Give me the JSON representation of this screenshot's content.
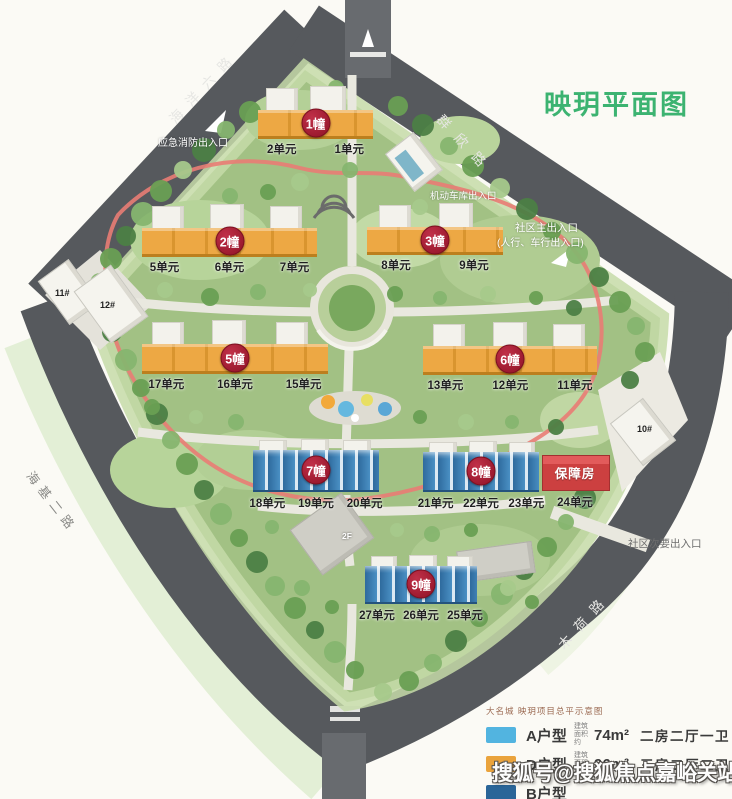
{
  "title": "映玥平面图",
  "roads": {
    "top_left": "海洋六路",
    "top_right": "群欣路",
    "bottom_left": "海基二路",
    "bottom_right": "木荷路"
  },
  "entrances": {
    "fire": "应急消防出入口",
    "garage": "机动车库出入口",
    "main_line1": "社区主出入口",
    "main_line2": "(人行、车行出入口)",
    "secondary": "社区次要出入口"
  },
  "buildings": [
    {
      "badge": "1幢",
      "units": [
        "2单元",
        "1单元"
      ]
    },
    {
      "badge": "2幢",
      "units": [
        "5单元",
        "6单元",
        "7单元"
      ]
    },
    {
      "badge": "3幢",
      "units": [
        "8单元",
        "9单元"
      ]
    },
    {
      "badge": "5幢",
      "units": [
        "17单元",
        "16单元",
        "15单元"
      ]
    },
    {
      "badge": "6幢",
      "units": [
        "13单元",
        "12单元",
        "11单元"
      ]
    },
    {
      "badge": "7幢",
      "units": [
        "18单元",
        "19单元",
        "20单元"
      ]
    },
    {
      "badge": "8幢",
      "units": [
        "21单元",
        "22单元",
        "23单元"
      ]
    },
    {
      "badge": "保障房",
      "units": [
        "24单元"
      ]
    },
    {
      "badge": "9幢",
      "units": [
        "27单元",
        "26单元",
        "25单元"
      ]
    }
  ],
  "site_labels": {
    "b11": "11#",
    "b12": "12#",
    "b10": "10#",
    "f2": "2F"
  },
  "legend": {
    "caption": "大名城 映玥项目总平示意图",
    "rows": [
      {
        "swatch": "#52b4e0",
        "label": "A户型",
        "area_prefix": "建筑面积约",
        "area": "74m²",
        "desc": "二房二厅一卫"
      },
      {
        "swatch": "#eaa33c",
        "label": "D户型",
        "area_prefix": "建筑面积约",
        "area": "96m²",
        "desc": "三房二厅二卫"
      },
      {
        "swatch": "#2a6598",
        "label": "B户型",
        "area_prefix": "",
        "area": "",
        "desc": ""
      }
    ]
  },
  "watermark": "搜狐号@搜狐焦点嘉峪关站",
  "colors": {
    "title_green": "#3cb371",
    "badge_red": "#9b1528",
    "building_orange": "#e9a23c",
    "building_blue": "#3b82b8",
    "affordable_red": "#cf4444",
    "road_gray": "#56595d",
    "site_green": "#a2c184"
  }
}
